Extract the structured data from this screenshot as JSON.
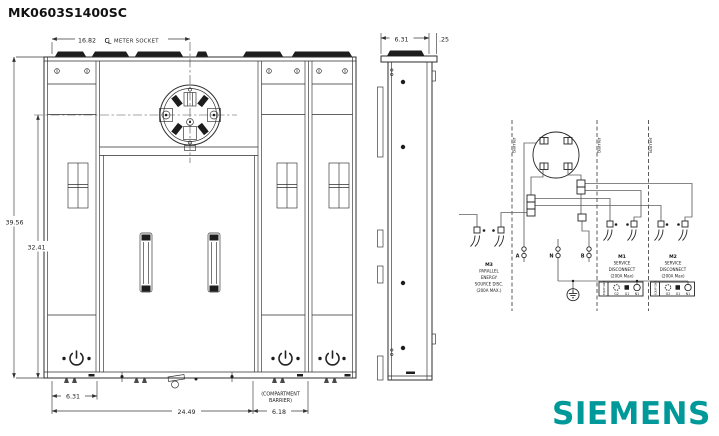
{
  "title": "MK0603S1400SC",
  "logo": {
    "text": "SIEMENS",
    "color": "#009999"
  },
  "front_view": {
    "dim_top_value": "16.82",
    "dim_top_cl": {
      "c": "C",
      "l": "L"
    },
    "dim_top_label": "METER SOCKET",
    "dim_height_total": "39.56",
    "dim_height_inner": "32.41",
    "dim_bottom_left": "6.31",
    "dim_bottom_center": "24.49",
    "dim_bottom_right": "6.18",
    "compartment_note_line1": "(COMPARTMENT",
    "compartment_note_line2": "BARRIER)"
  },
  "side_view": {
    "dim_width": "6.31",
    "dim_flange": ".25"
  },
  "schematic": {
    "barrier_label": "Barrier",
    "m3": {
      "name": "M3",
      "line1": "PARALLEL",
      "line2": "ENERGY",
      "line3": "SOURCE DISC.",
      "line4": "(200A MAX.)"
    },
    "m1": {
      "name": "M1",
      "line1": "SERVICE",
      "line2": "DISCONNECT",
      "line3": "(200A Max)"
    },
    "m2": {
      "name": "M2",
      "line1": "SERVICE",
      "line2": "DISCONNECT",
      "line3": "(200A Max)"
    },
    "phase_a": "A",
    "neutral": "N",
    "phase_b": "B",
    "strip": {
      "equip_gnd": "EQUIP GND",
      "g2": "G2",
      "g1": "G1",
      "n1": "N1"
    }
  }
}
